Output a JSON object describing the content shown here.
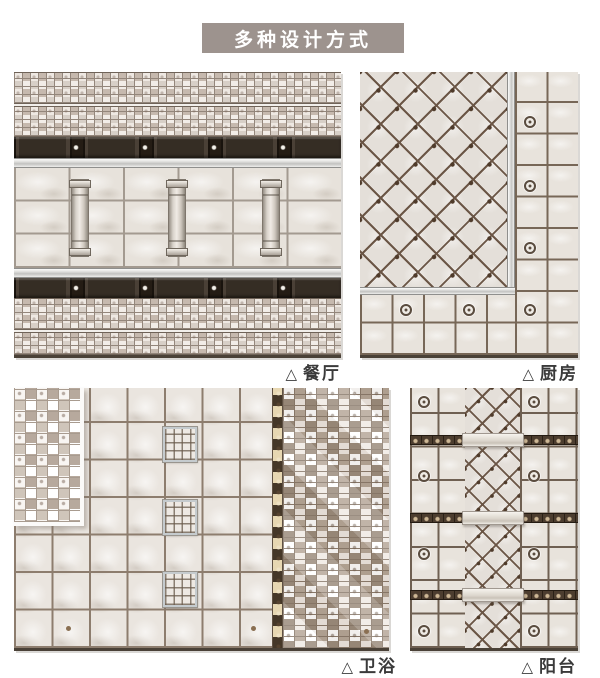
{
  "title": "多种设计方式",
  "panels": [
    {
      "key": "dining",
      "marker": "△",
      "label": "餐厅"
    },
    {
      "key": "kitchen",
      "marker": "△",
      "label": "厨房"
    },
    {
      "key": "bathroom",
      "marker": "△",
      "label": "卫浴"
    },
    {
      "key": "balcony",
      "marker": "△",
      "label": "阳台"
    }
  ],
  "colors": {
    "banner_bg": "#9d938e",
    "banner_text": "#ffffff",
    "caption_text": "#3a3a3a",
    "tile_light": "#e7e2db",
    "mosaic_taupe": "#b7a99d",
    "grout_brown": "#6f6052",
    "listello_dark": "#342c24",
    "listello_beige": "#e7d7b2",
    "silver_strip": "#d9d9d7",
    "panel_edge": "#4a4137"
  }
}
